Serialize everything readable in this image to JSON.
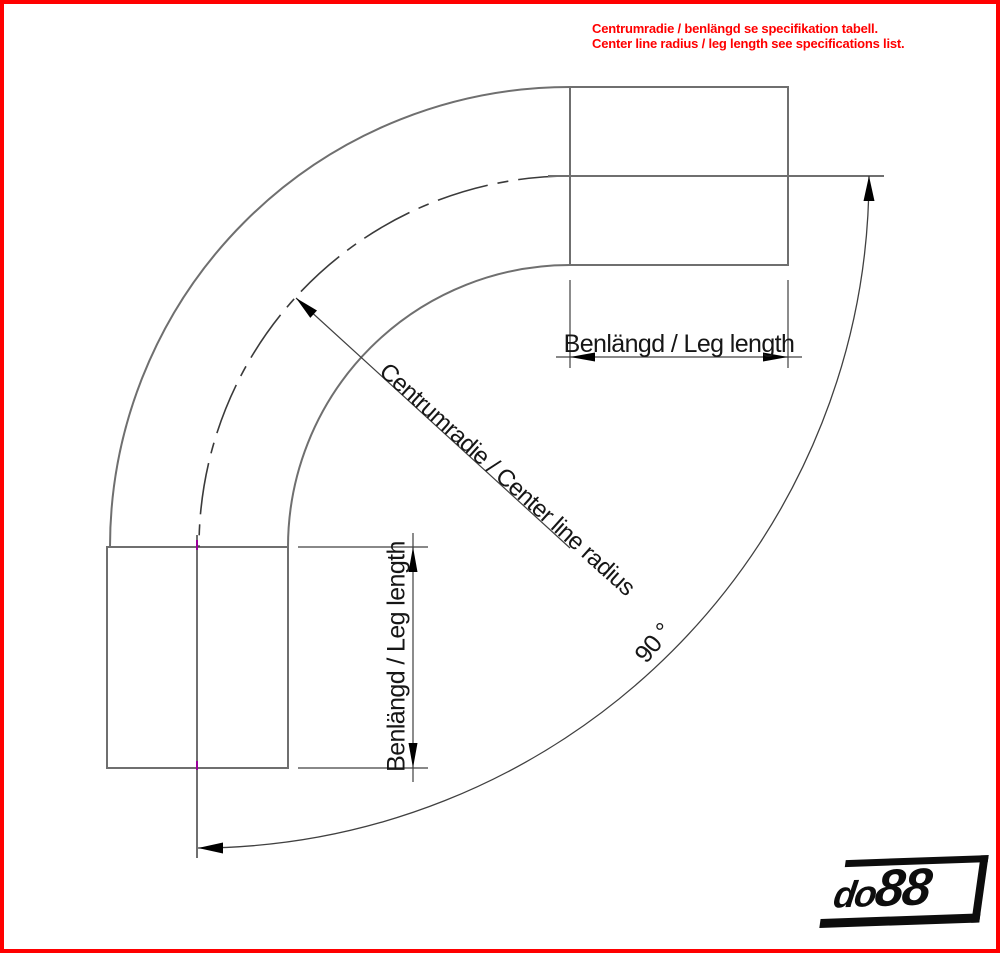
{
  "note": {
    "line1": "Centrumradie / benlängd se specifikation tabell.",
    "line2": "Center line radius / leg length see specifications list.",
    "color": "#FF0000"
  },
  "labels": {
    "leg_top": "Benlängd / Leg length",
    "leg_left": "Benlängd / Leg length",
    "radius": "Centrumradie / Center line radius",
    "angle": "90 °"
  },
  "logo": {
    "do": "do",
    "eights": "88"
  },
  "colors": {
    "frame_border": "#FF0000",
    "geometry_line": "#6f6f6f",
    "centerline": "#3a3a3a",
    "dimension_line": "#404040",
    "arrow": "#000000",
    "text": "#161616",
    "logo": "#0d0d0d",
    "cad_tick": "#990099"
  }
}
